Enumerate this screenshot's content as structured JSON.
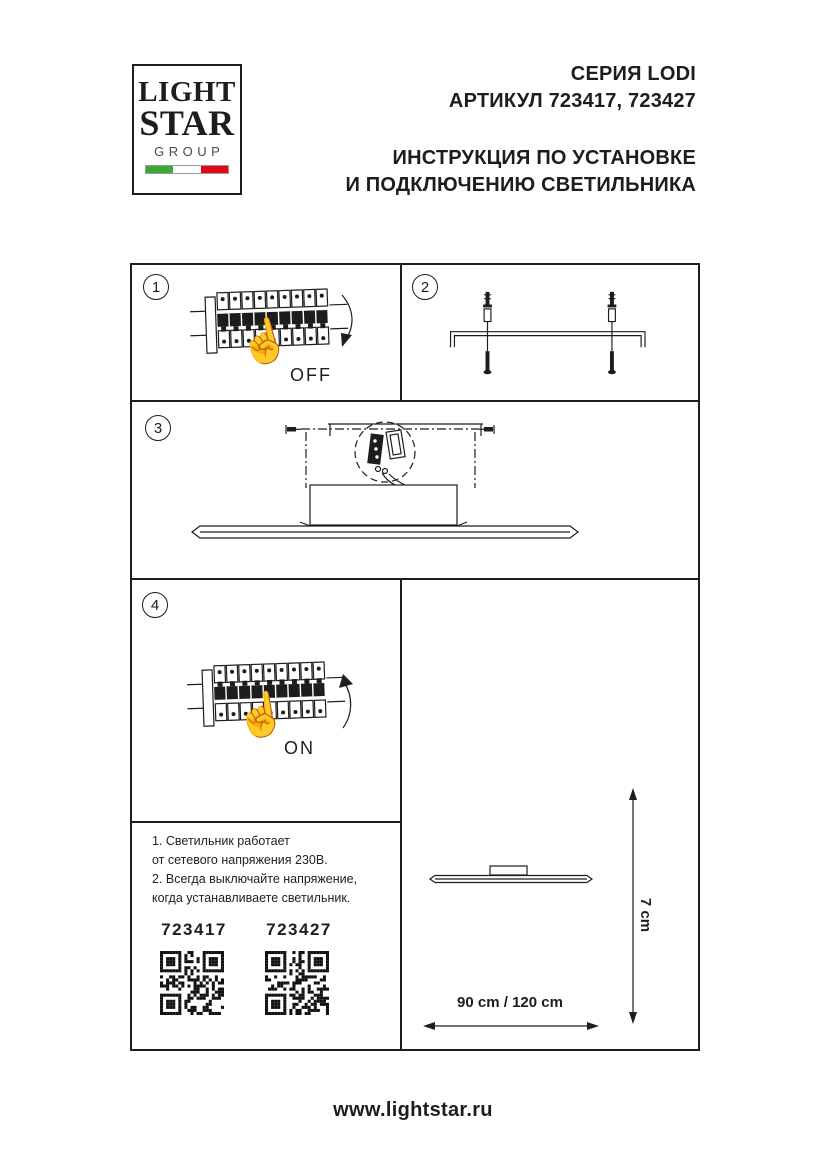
{
  "header": {
    "logo": {
      "line1": "LIGHT",
      "line2": "STAR",
      "line3": "GROUP"
    },
    "series": "СЕРИЯ LODI",
    "articles": "АРТИКУЛ 723417, 723427",
    "title_line1": "ИНСТРУКЦИЯ ПО УСТАНОВКЕ",
    "title_line2": "И ПОДКЛЮЧЕНИЮ СВЕТИЛЬНИКА"
  },
  "steps": [
    {
      "number": "1",
      "switch_label": "OFF"
    },
    {
      "number": "2"
    },
    {
      "number": "3"
    },
    {
      "number": "4",
      "switch_label": "ON"
    }
  ],
  "notes": {
    "line1": "1. Светильник работает",
    "line2": "от сетевого напряжения 230В.",
    "line3": "2. Всегда выключайте напряжение,",
    "line4": "когда устанавливаете светильник."
  },
  "qr_codes": [
    {
      "label": "723417"
    },
    {
      "label": "723427"
    }
  ],
  "dimensions": {
    "width": "90 cm / 120 cm",
    "height": "7 cm"
  },
  "footer": {
    "website": "www.lightstar.ru"
  },
  "colors": {
    "ink": "#1d1d1b",
    "flag_green": "#3aaa35",
    "flag_red": "#e30613"
  }
}
